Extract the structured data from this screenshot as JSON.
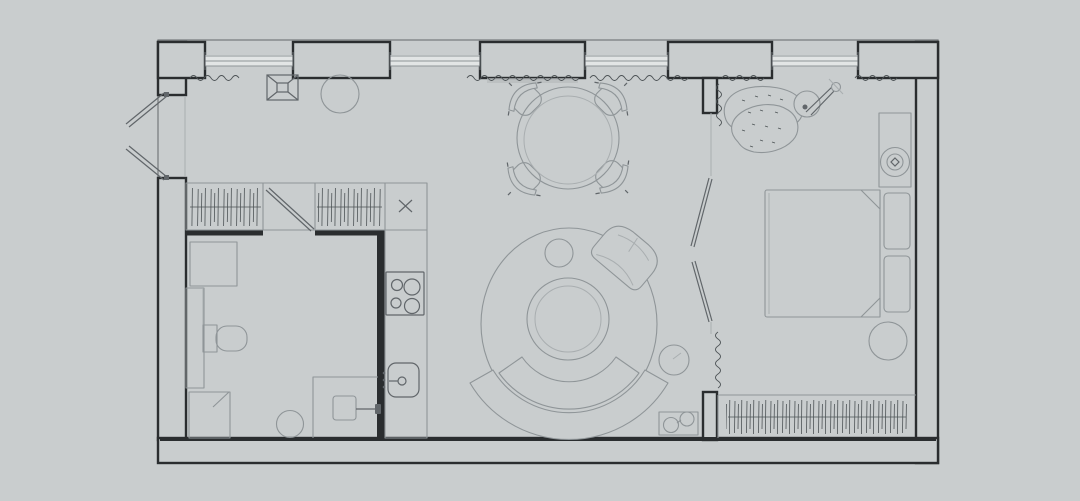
{
  "meta": {
    "title": "studio-apartment-floor-plan",
    "canvas_width": 1080,
    "canvas_height": 501,
    "visible_text": "none"
  },
  "palette": {
    "background": "#c9cdce",
    "outer": "#75797b",
    "wall": "#2a2d2f",
    "furniture": "#8f9598",
    "furniture_light": "#a9aeb0",
    "detail": "#61666a",
    "hatch": "#4d5356",
    "window_fill": "#e2e5e5",
    "shade": "#b6babc"
  },
  "inventory": {
    "rooms": [
      "entry-hall",
      "bathroom",
      "kitchen-run",
      "living-dining-area",
      "bedroom"
    ],
    "structure": [
      "exterior-walls",
      "window-strips-top-wall",
      "double-entry-door-left",
      "sliding-partition-living-bedroom",
      "sliding-door-bathroom",
      "insulation-wavy-hatching"
    ],
    "entry_hall": [
      "extractor-vent-symbol",
      "round-ceiling-lamp",
      "wardrobe-hatched-left",
      "wardrobe-hatched-right",
      "tall-cabinet-x-mark"
    ],
    "bathroom": [
      "corner-cabinet",
      "vanity-counter",
      "toilet",
      "shower-tray",
      "round-stool",
      "washbasin-unit",
      "wall-faucet-fixture"
    ],
    "kitchen": [
      "counter-run",
      "four-burner-hob",
      "sink-with-tap"
    ],
    "living_dining": [
      "round-dining-table",
      "dining-chair-nw",
      "dining-chair-ne",
      "dining-chair-sw",
      "dining-chair-se",
      "round-rug",
      "round-coffee-table",
      "small-pouf-on-rug",
      "curved-sofa-back",
      "curved-sofa-seat",
      "swivel-armchair",
      "round-side-table",
      "tray-with-cups"
    ],
    "bedroom": [
      "lounge-chair",
      "arc-floor-lamp",
      "bedside-desk",
      "round-stool-top",
      "double-bed",
      "pillow-upper",
      "pillow-lower",
      "blanket-fold-corners",
      "round-pouf",
      "wardrobe-hanging-rail"
    ]
  }
}
